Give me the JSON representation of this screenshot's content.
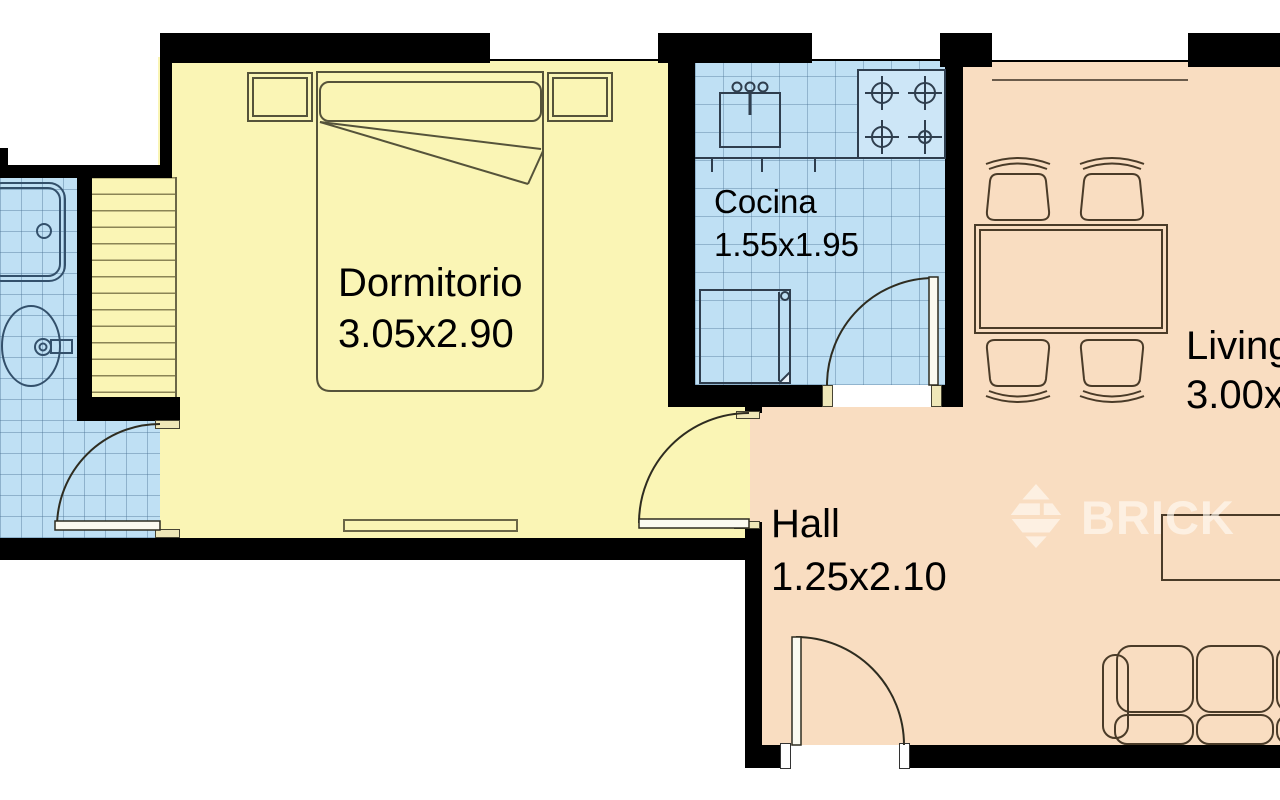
{
  "watermark": {
    "brand": "BRICK"
  },
  "rooms": {
    "bedroom": {
      "label": "Dormitorio",
      "dims": "3.05x2.90",
      "floor_color": "#FAF5B5"
    },
    "kitchen": {
      "label": "Cocina",
      "dims": "1.55x1.95",
      "floor_color": "#BFE0F4"
    },
    "hall": {
      "label": "Hall",
      "dims": "1.25x2.10",
      "floor_color": "#F9DDC1"
    },
    "living": {
      "label": "Living",
      "dims": "3.00x",
      "floor_color": "#F9DDC1"
    },
    "bathroom": {
      "floor_color": "#BFE0F4"
    }
  },
  "icons": {
    "watermark_icon": "brick-diamond-icon"
  },
  "colors": {
    "wall": "#000000",
    "window": "#FFFFFF",
    "furniture_line": "#3f3c2c"
  }
}
